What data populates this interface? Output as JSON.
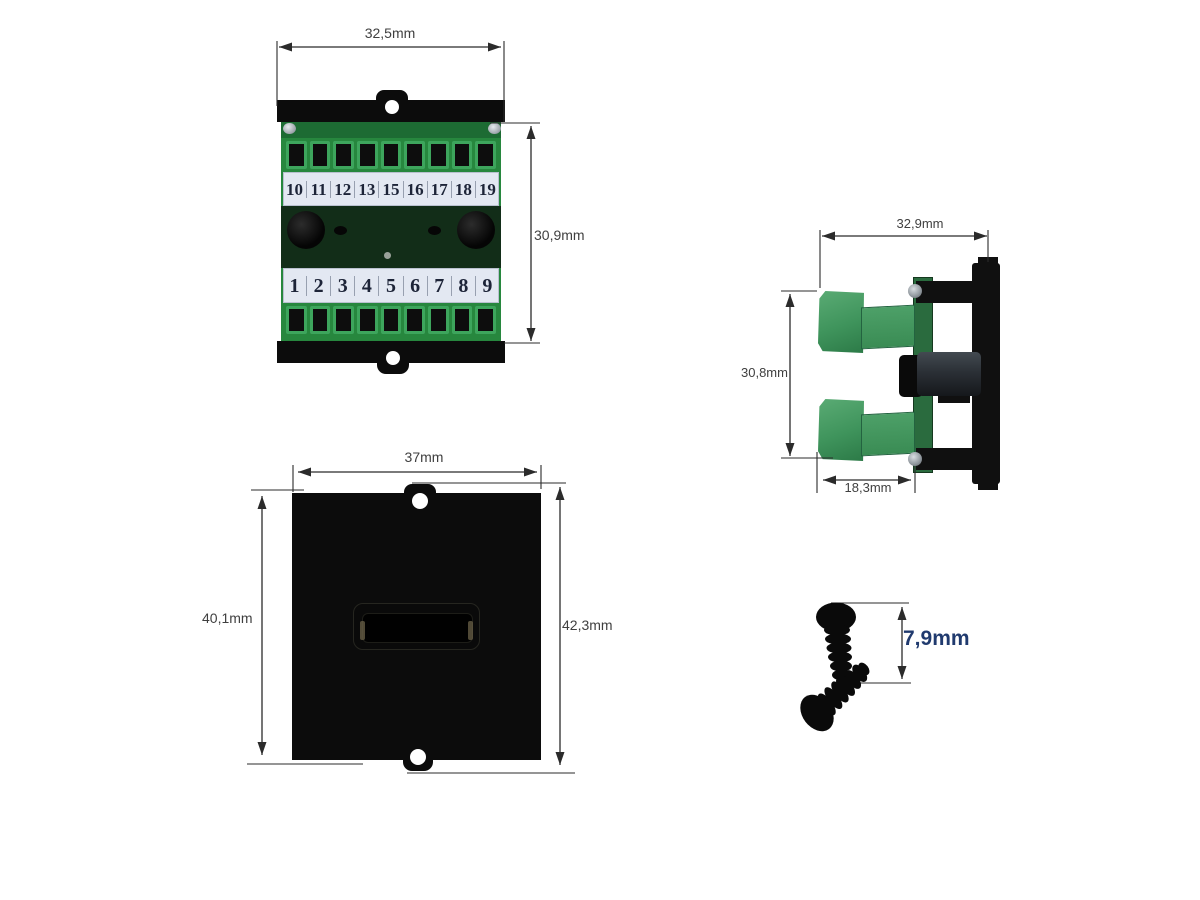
{
  "rear_view": {
    "width_label": "32,5mm",
    "height_label": "30,9mm",
    "terminals_top": [
      "10",
      "11",
      "12",
      "13",
      "15",
      "16",
      "17",
      "18",
      "19"
    ],
    "terminals_bottom": [
      "1",
      "2",
      "3",
      "4",
      "5",
      "6",
      "7",
      "8",
      "9"
    ]
  },
  "side_view": {
    "width_label": "32,9mm",
    "height_label": "30,8mm",
    "depth_label": "18,3mm"
  },
  "front_view": {
    "width_label": "37mm",
    "height_left_label": "40,1mm",
    "height_right_label": "42,3mm"
  },
  "screws": {
    "length_label": "7,9mm"
  },
  "colors": {
    "terminal_green": "#2f9149",
    "terminal_green_light": "#3da55c",
    "pcb_dark_green": "#122d18",
    "label_strip": "#e3e8f2",
    "black_part": "#0c0c0c",
    "dim_line": "#2b2b2b",
    "dim_text": "#3f3f3f",
    "screw_dim_text": "#203a6e"
  }
}
